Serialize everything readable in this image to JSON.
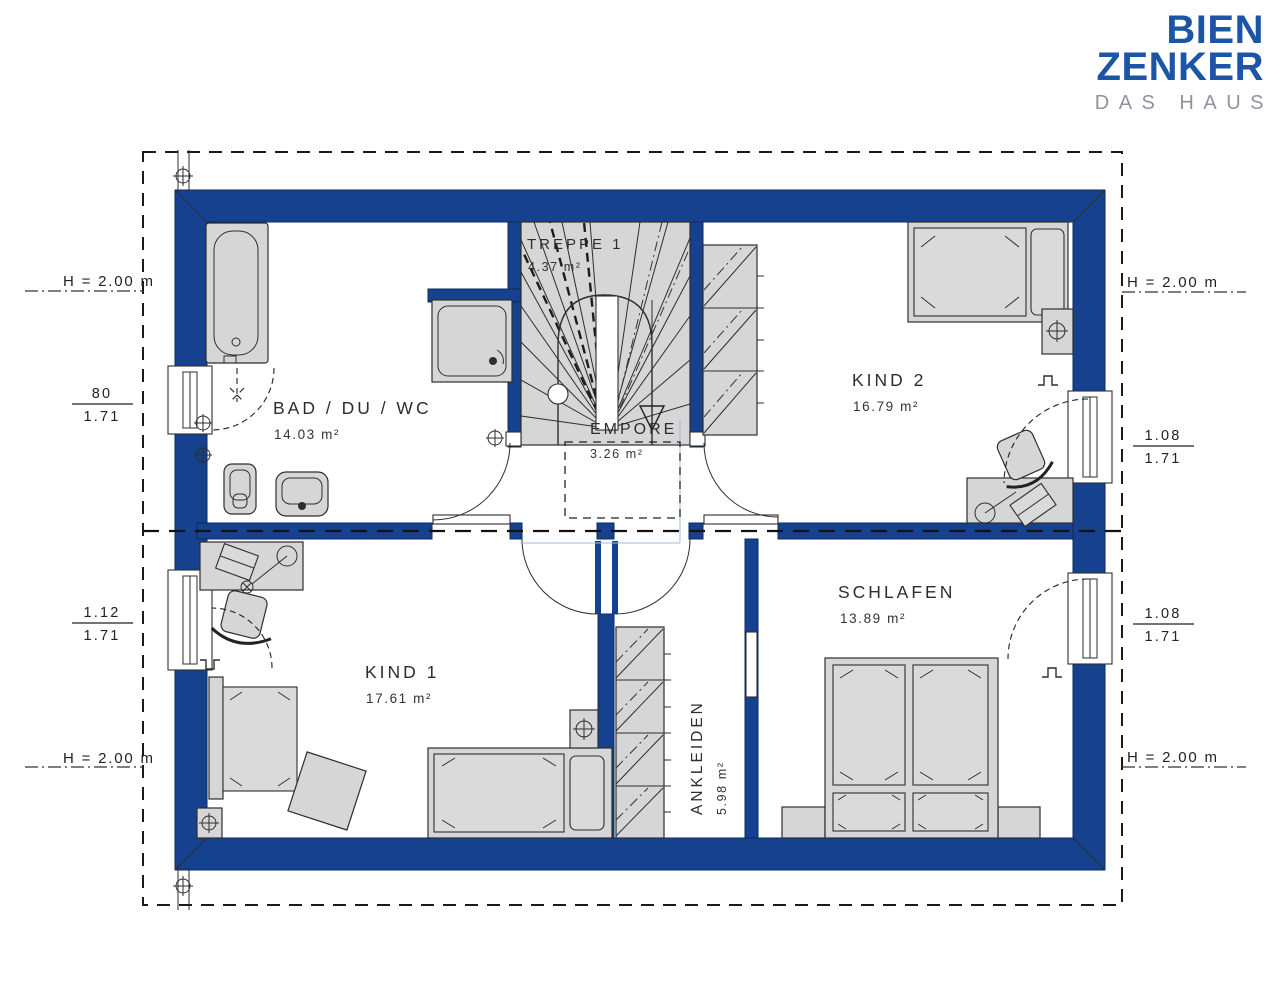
{
  "brand": {
    "line1": "BIEN",
    "line2": "ZENKER",
    "tagline": "DAS HAUS"
  },
  "rooms": {
    "bad": {
      "name": "BAD / DU / WC",
      "area": "14.03 m²"
    },
    "treppe": {
      "name": "TREPPE 1",
      "area": "4.37 m²"
    },
    "kind2": {
      "name": "KIND 2",
      "area": "16.79 m²"
    },
    "empore": {
      "name": "EMPORE",
      "area": "3.26 m²"
    },
    "kind1": {
      "name": "KIND 1",
      "area": "17.61 m²"
    },
    "ankleiden": {
      "name": "ANKLEIDEN",
      "area": "5.98 m²"
    },
    "schlafen": {
      "name": "SCHLAFEN",
      "area": "13.89 m²"
    }
  },
  "dimensions": {
    "left": {
      "height_top": "H = 2.00 m",
      "win_top": {
        "num": "80",
        "den": "1.71"
      },
      "win_bottom": {
        "num": "1.12",
        "den": "1.71"
      },
      "height_bottom": "H = 2.00 m"
    },
    "right": {
      "height_top": "H = 2.00 m",
      "win_top": {
        "num": "1.08",
        "den": "1.71"
      },
      "win_bottom": {
        "num": "1.08",
        "den": "1.71"
      },
      "height_bottom": "H = 2.00 m"
    }
  },
  "colors": {
    "wall": "#16418f",
    "logo_blue": "#1d55a5",
    "tagline_gray": "#8e939d",
    "furniture_fill": "#d6d6d6"
  }
}
